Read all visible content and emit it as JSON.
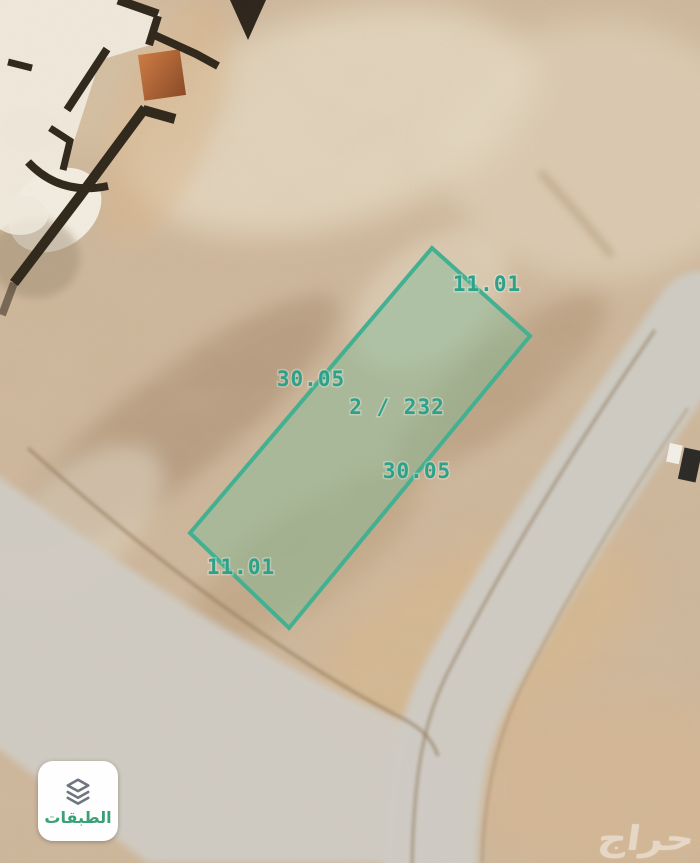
{
  "map": {
    "type": "satellite-parcel-view",
    "parcel": {
      "number": "2 / 232",
      "dimensions": {
        "top": "11.01",
        "left": "30.05",
        "right": "30.05",
        "bottom": "11.01"
      },
      "outline_color": "#43b091",
      "fill_color": "rgba(130,186,150,0.48)",
      "label_color": "#2da189"
    },
    "watermark_text": "حراج"
  },
  "controls": {
    "layers_button": {
      "label": "الطبقات",
      "label_color": "#3aa076",
      "icon": "layers-icon"
    }
  }
}
